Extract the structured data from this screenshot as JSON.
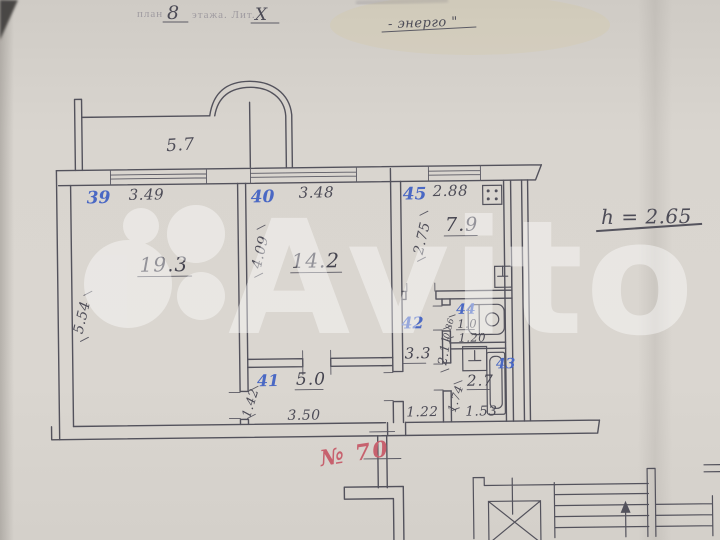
{
  "header": {
    "printed_prefix": "план",
    "floor_number": "8",
    "printed_suffix": "этажа. Лит.",
    "liter": "X",
    "note_right": "- энерго \""
  },
  "plan": {
    "balcony_width": "5.7",
    "ceiling_height": "h = 2.65",
    "apartment_number": "№ 70",
    "rooms": [
      {
        "id": "39",
        "area": "19.3",
        "width": "3.49",
        "depth": "5.54"
      },
      {
        "id": "40",
        "area": "14.2",
        "width": "3.48",
        "depth": "4.09"
      },
      {
        "id": "45",
        "area": "7.9",
        "width": "2.88",
        "depth": "2.75"
      },
      {
        "id": "41",
        "area": "5.0",
        "width": "3.50",
        "depth": "1.42"
      },
      {
        "id": "42",
        "area": "3.3",
        "width": "1.22",
        "depth": "2.11"
      },
      {
        "id": "44",
        "area": "1.0",
        "width": "1.20",
        "depth": "0.86"
      },
      {
        "id": "43",
        "area": "2.7",
        "width": "1.53",
        "depth": "1.74"
      }
    ]
  },
  "watermark": {
    "brand": "Avito"
  },
  "colors": {
    "paper": "#d8d4ce",
    "ink": "#53525c",
    "blue_pen": "#4a68c4",
    "red_pen": "#c7616e"
  }
}
